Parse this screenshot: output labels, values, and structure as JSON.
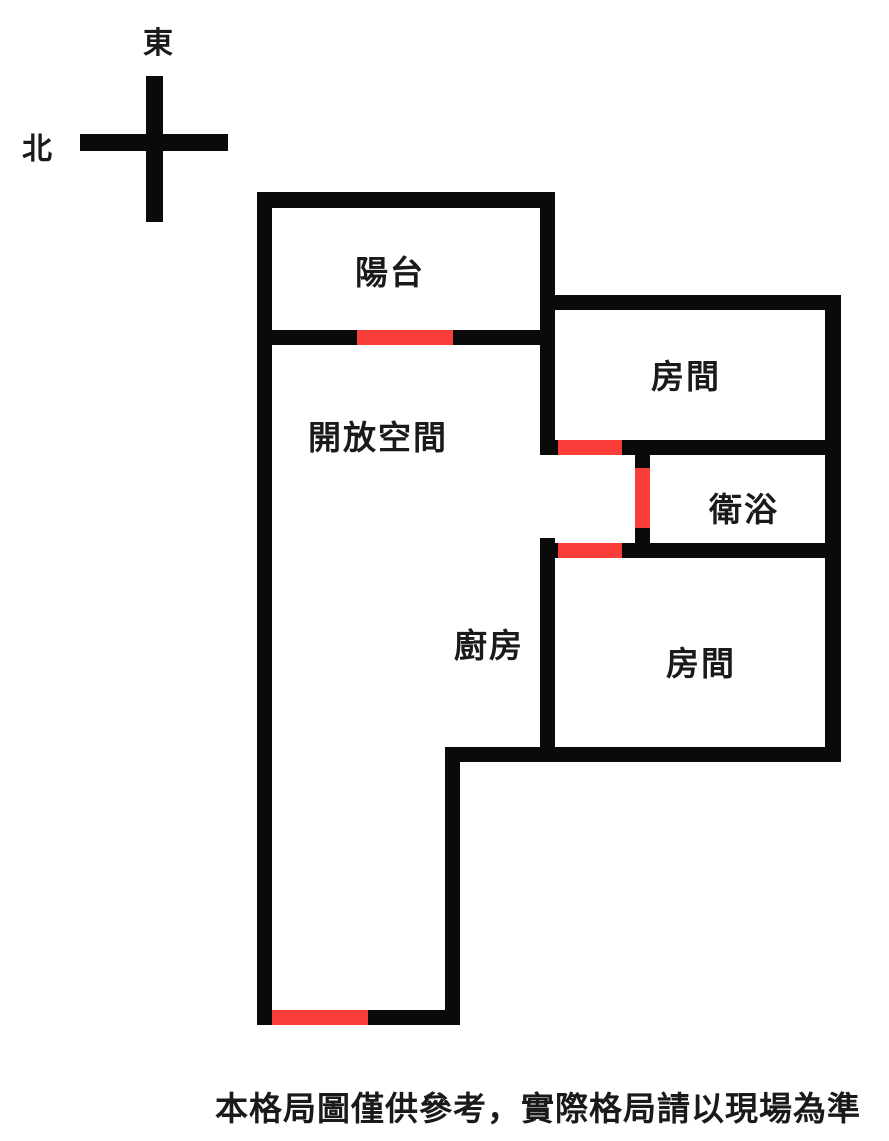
{
  "compass": {
    "east_label": "東",
    "north_label": "北"
  },
  "rooms": {
    "balcony": {
      "label": "陽台"
    },
    "open_space": {
      "label": "開放空間"
    },
    "bedroom_top": {
      "label": "房間"
    },
    "bathroom": {
      "label": "衛浴"
    },
    "kitchen": {
      "label": "廚房"
    },
    "bedroom_bottom": {
      "label": "房間"
    }
  },
  "footer": {
    "disclaimer": "本格局圖僅供參考，實際格局請以現場為準"
  },
  "colors": {
    "wall": "#0A0A0A",
    "door": "#F93E3A",
    "text": "#1A1A1A",
    "background": "#FFFFFF"
  }
}
